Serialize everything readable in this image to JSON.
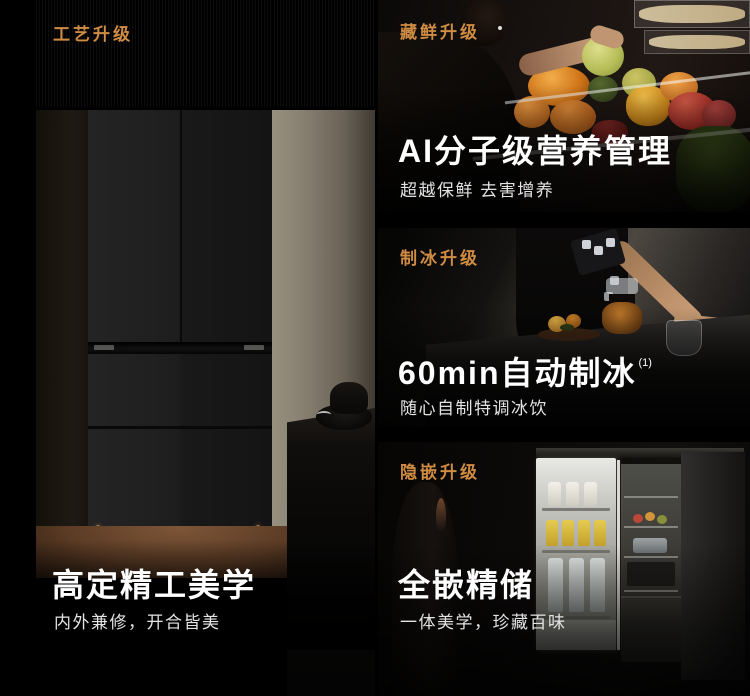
{
  "colors": {
    "accent": "#cf8c42",
    "title": "#ffffff",
    "subtitle": "#e3e3e3"
  },
  "craft_section": {
    "tag": "工艺升级",
    "title": "高定精工美学",
    "subtitle": "内外兼修，开合皆美"
  },
  "sections": [
    {
      "tag": "藏鲜升级",
      "title": "AI分子级营养管理",
      "sup": "",
      "subtitle": "超越保鲜 去害增养"
    },
    {
      "tag": "制冰升级",
      "title": "60min自动制冰",
      "sup": "(1)",
      "subtitle": "随心自制特调冰饮"
    },
    {
      "tag": "隐嵌升级",
      "title": "全嵌精储",
      "sup": "",
      "subtitle": "一体美学，珍藏百味"
    }
  ]
}
